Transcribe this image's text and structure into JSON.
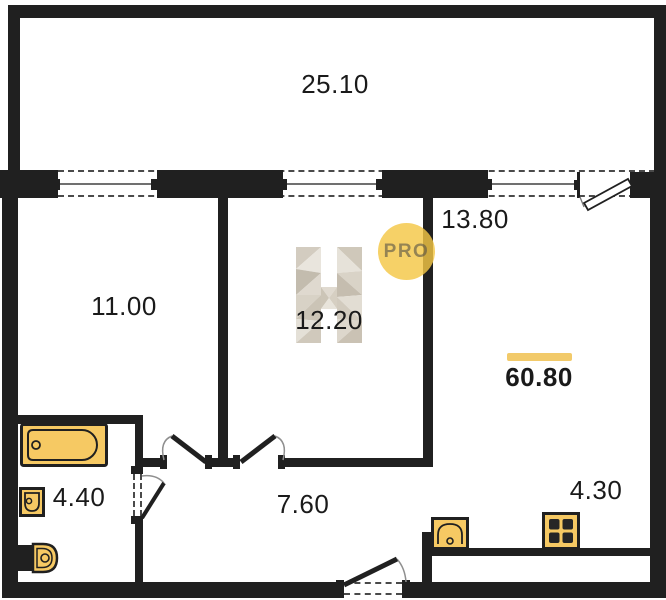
{
  "plan": {
    "total_area": "60.80",
    "rooms": [
      {
        "room": "terrace",
        "area": "25.10"
      },
      {
        "room": "room-left",
        "area": "11.00"
      },
      {
        "room": "room-middle",
        "area": "12.20"
      },
      {
        "room": "room-right",
        "area": "13.80"
      },
      {
        "room": "bathroom",
        "area": "4.40"
      },
      {
        "room": "hallway",
        "area": "7.60"
      },
      {
        "room": "kitchen-zone",
        "area": "4.30"
      }
    ]
  },
  "watermark": {
    "badge_text": "PRO"
  },
  "colors": {
    "background": "#ffffff",
    "wall": "#202020",
    "fixture_fill": "#F6C963",
    "fixture_outline": "#202020",
    "accent_bar": "#F2CA6A",
    "badge_fill": "rgba(244,199,70,0.82)",
    "badge_text": "rgba(85,80,70,0.6)",
    "label_text": "#1a1a1a"
  }
}
